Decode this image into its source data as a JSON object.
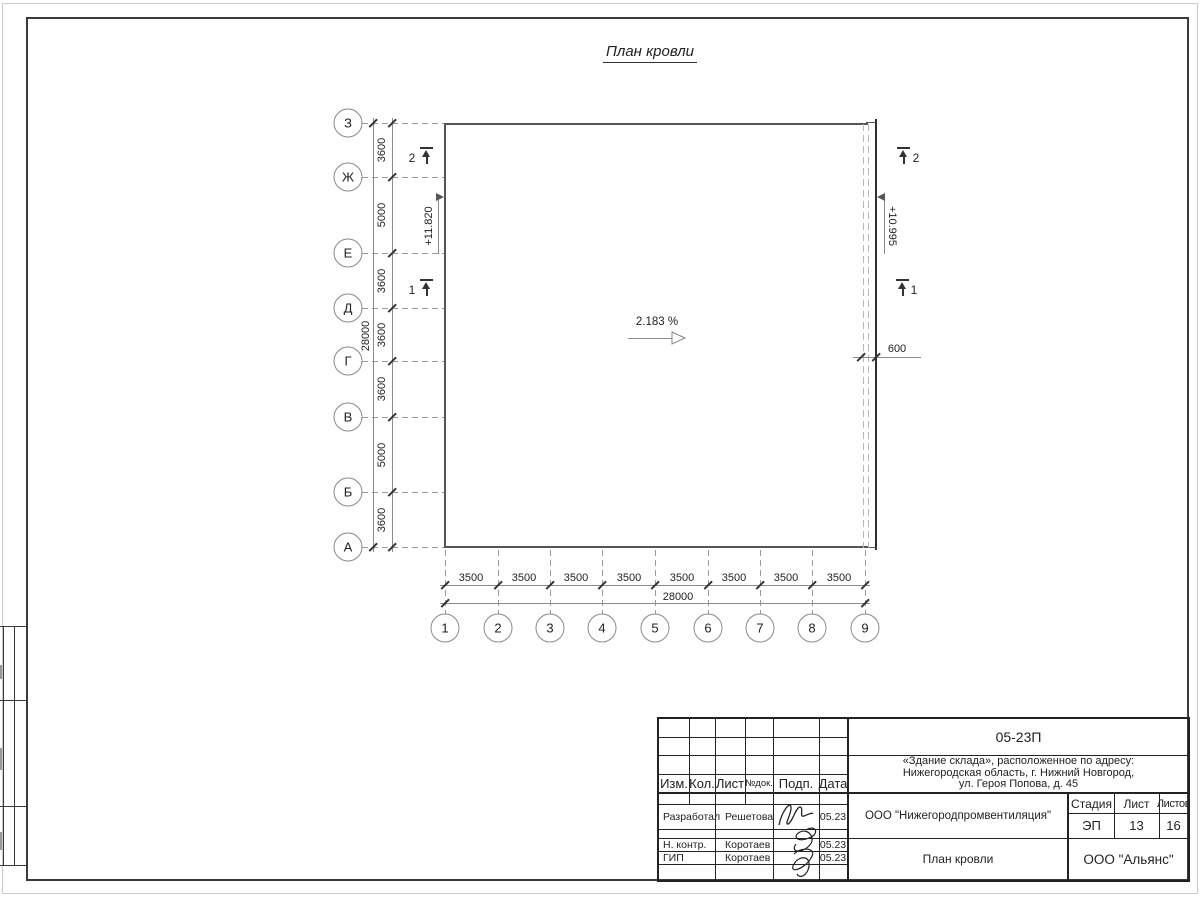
{
  "sheet": {
    "title": "План кровли"
  },
  "plan": {
    "slope_label": "2.183 %",
    "elevation_left": "+11.820",
    "elevation_right": "+10.995",
    "overhang_dim": "600",
    "axes_left": {
      "labels": [
        "З",
        "Ж",
        "Е",
        "Д",
        "Г",
        "В",
        "Б",
        "А"
      ],
      "segment_dims": [
        "3600",
        "5000",
        "3600",
        "3600",
        "3600",
        "5000",
        "3600"
      ],
      "total_dim": "28000"
    },
    "axes_bottom": {
      "labels": [
        "1",
        "2",
        "3",
        "4",
        "5",
        "6",
        "7",
        "8",
        "9"
      ],
      "segment_dims": [
        "3500",
        "3500",
        "3500",
        "3500",
        "3500",
        "3500",
        "3500",
        "3500"
      ],
      "total_dim": "28000"
    },
    "section_marks": {
      "left_top": "2",
      "left_bottom": "1",
      "right_top": "2",
      "right_bottom": "1"
    }
  },
  "titleblock": {
    "code": "05-23П",
    "project_line1": "«Здание склада», расположенное по адресу:",
    "project_line2": "Нижегородская область, г. Нижний Новгород,",
    "project_line3": "ул. Героя Попова, д. 45",
    "org": "ООО \"Нижегородпромвентиляция\"",
    "doc_title": "План кровли",
    "firm": "ООО \"Альянс\"",
    "header_cols": {
      "izm": "Изм.",
      "kol": "Кол.",
      "list": "Лист",
      "ndok": "№док.",
      "podp": "Подп.",
      "data": "Дата"
    },
    "stage": {
      "stadia_label": "Стадия",
      "list_label": "Лист",
      "listov_label": "Листов",
      "stadia": "ЭП",
      "list": "13",
      "listov": "16"
    },
    "rows": [
      {
        "role": "Разработал",
        "name": "Решетова",
        "date": "05.23"
      },
      {
        "role": "Н. контр.",
        "name": "Коротаев",
        "date": "05.23"
      },
      {
        "role": "ГИП",
        "name": "Коротаев",
        "date": "05.23"
      }
    ]
  }
}
